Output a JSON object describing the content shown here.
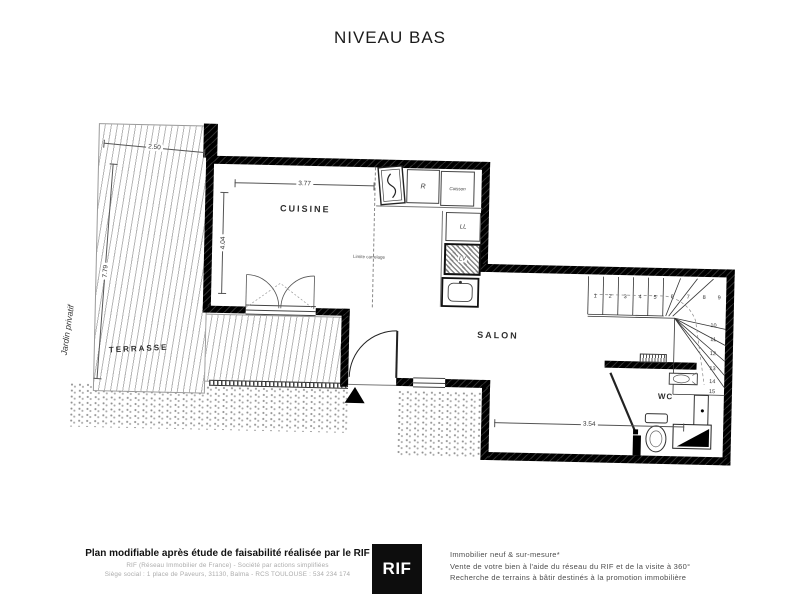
{
  "title": "NIVEAU BAS",
  "plan": {
    "rooms": {
      "terrasse": "TERRASSE",
      "cuisine": "CUISINE",
      "salon": "SALON",
      "wc": "WC"
    },
    "garden_label": "Jardin privatif",
    "tiling_label": "Limite carrelage",
    "appliances": {
      "fridge": "R",
      "cooking": "Cuisson",
      "washer": "LL",
      "dishwasher": "LV"
    },
    "dimensions": {
      "cuisine_width": "3.77",
      "cuisine_height": "4.04",
      "terrasse_width": "2.50",
      "terrasse_height": "7.79",
      "salon_width": "3.54"
    },
    "stairs": {
      "steps": [
        "1",
        "2",
        "3",
        "4",
        "5",
        "6",
        "7",
        "8",
        "9",
        "10",
        "11",
        "12",
        "13",
        "14",
        "15"
      ]
    }
  },
  "footer": {
    "left": {
      "line1": "Plan modifiable après étude de faisabilité réalisée par le RIF",
      "line2": "RIF (Réseau Immobilier de France) - Société par actions simplifiées",
      "line3": "Siège social : 1 place de Paveurs, 31130, Balma - RCS TOULOUSE : 534 234 174"
    },
    "logo": "RIF",
    "right": {
      "line1": "Immobilier neuf & sur-mesure*",
      "line2": "Vente de votre bien à l'aide du réseau du RIF et de la visite à 360°",
      "line3": "Recherche de terrains à bâtir destinés à la promotion immobilière"
    }
  }
}
